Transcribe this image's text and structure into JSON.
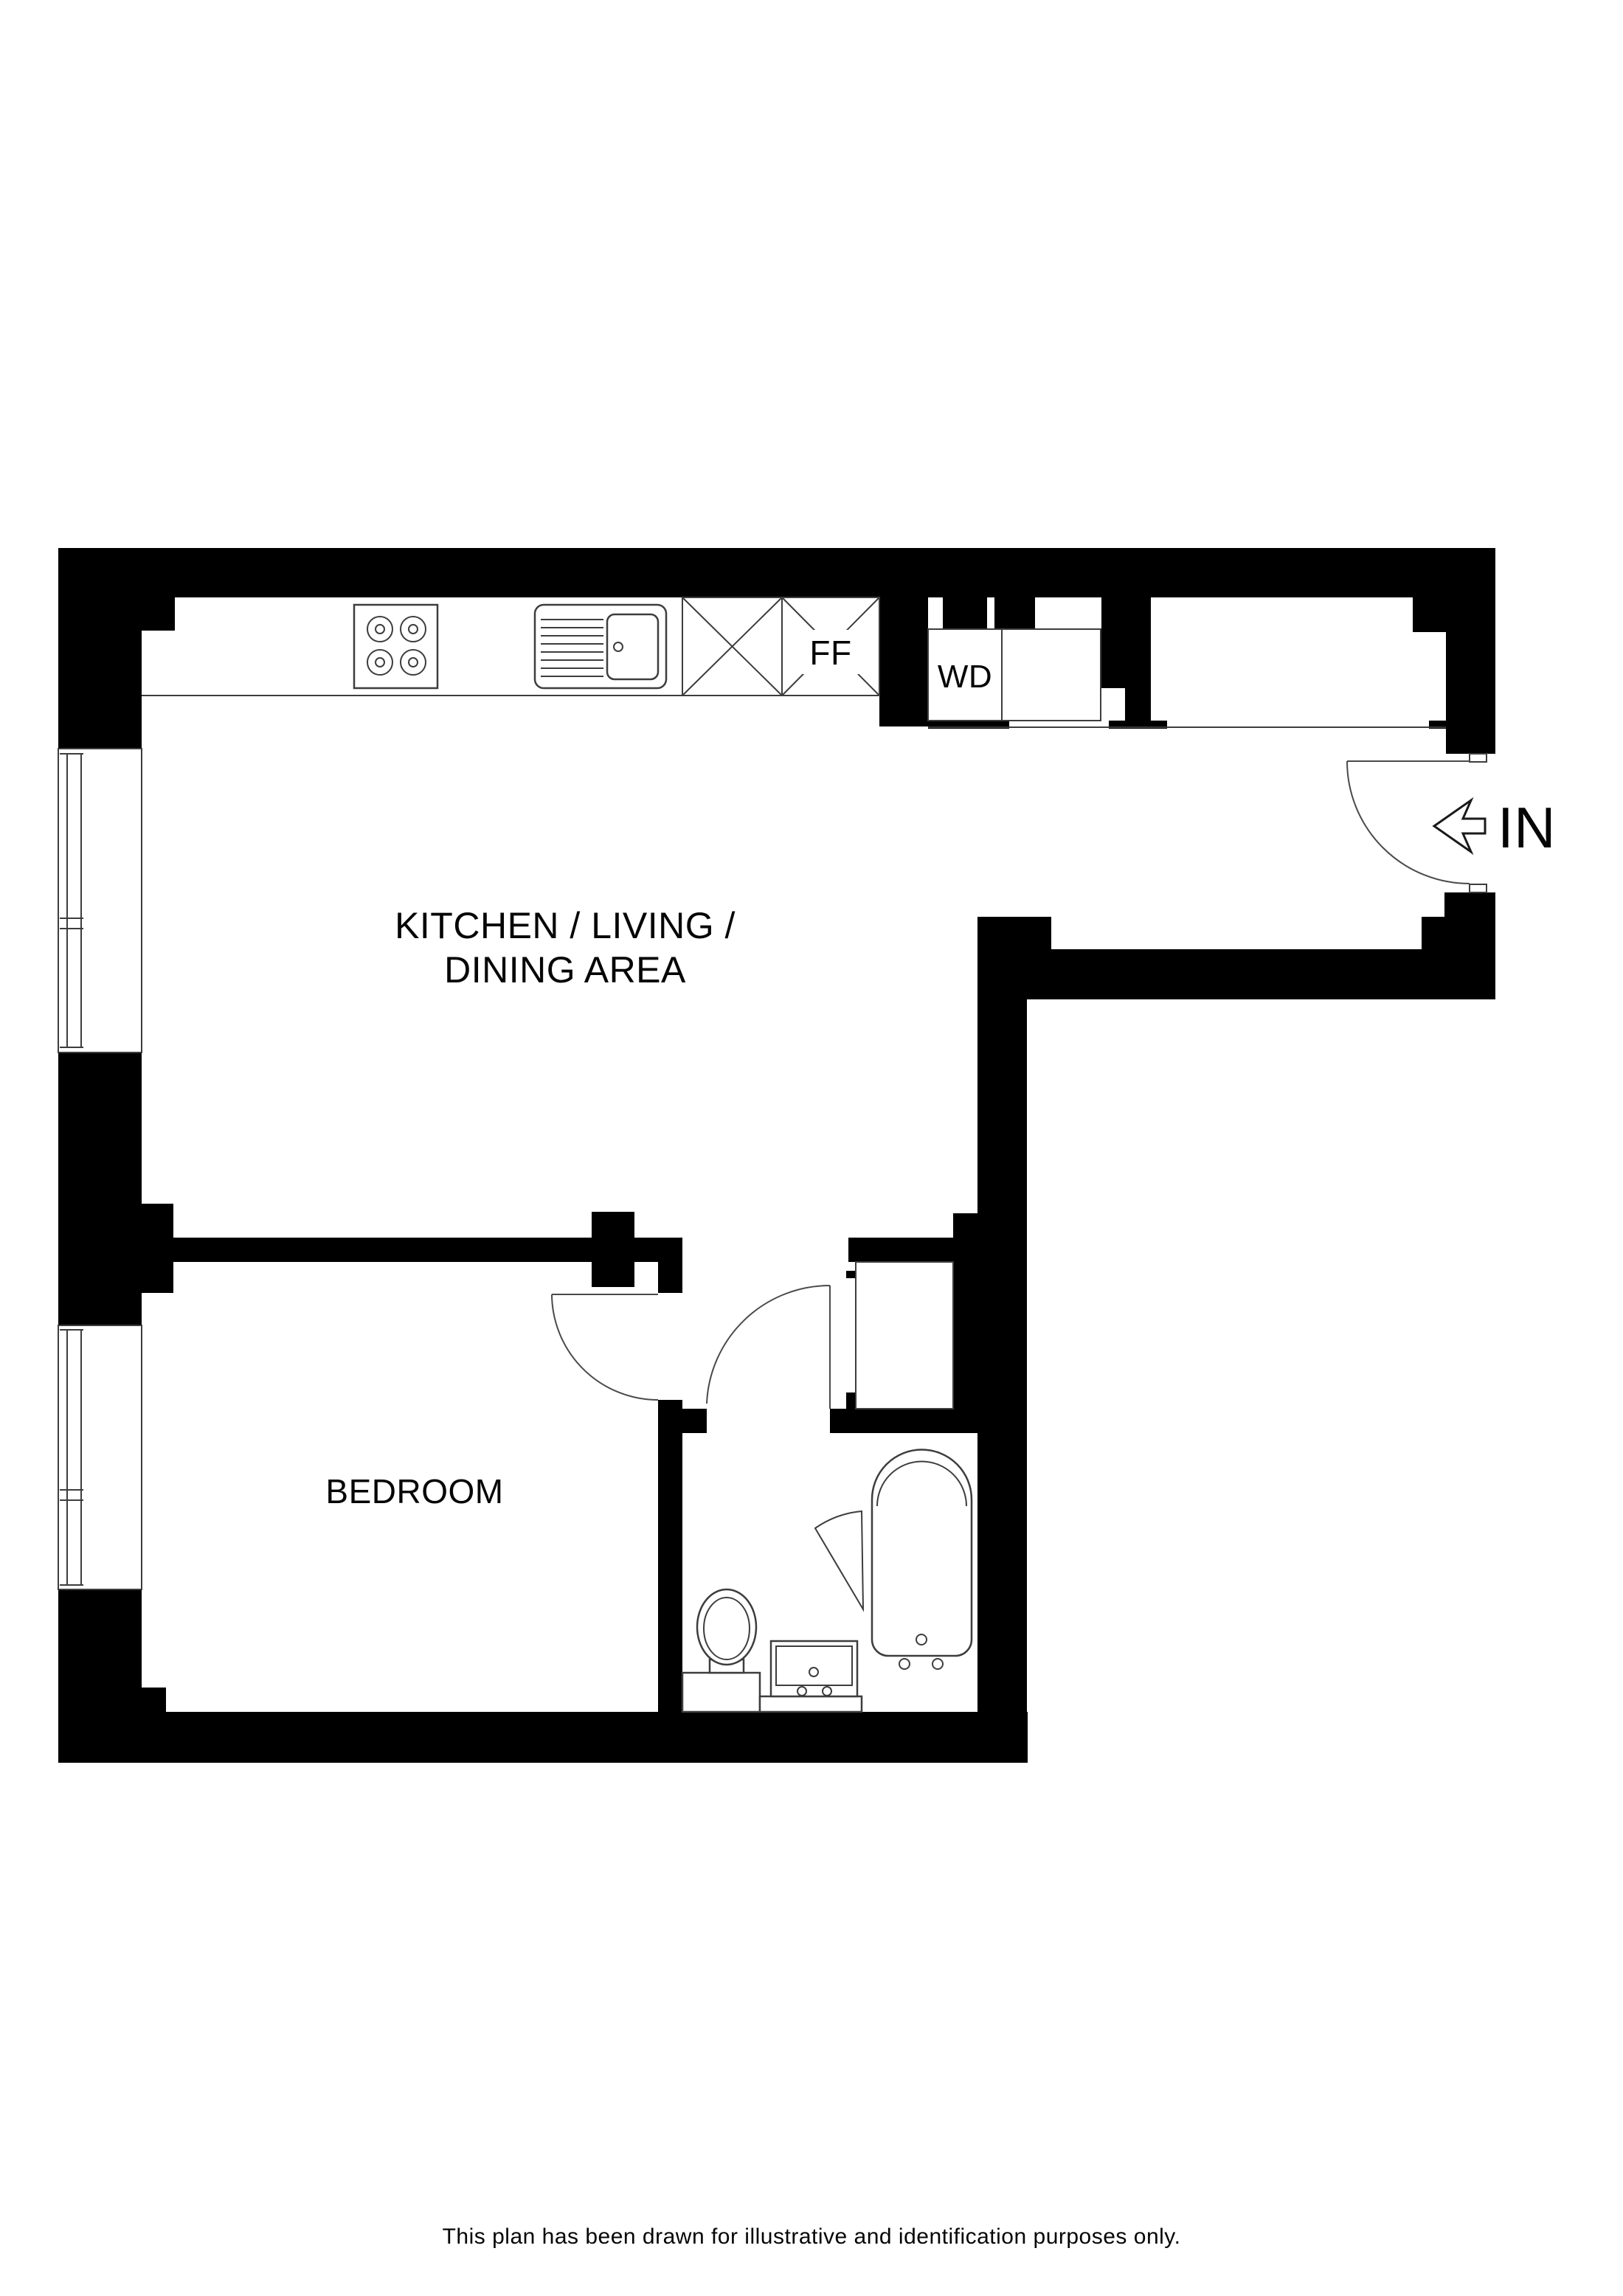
{
  "floorplan": {
    "rooms": [
      {
        "id": "kitchen-living-dining",
        "label_line1": "KITCHEN / LIVING /",
        "label_line2": "DINING AREA"
      },
      {
        "id": "bedroom",
        "label": "BEDROOM"
      }
    ],
    "appliances": {
      "fridge_freezer_label": "FF",
      "washer_dryer_label": "WD"
    },
    "entrance": {
      "label": "IN"
    },
    "footer": {
      "disclaimer": "This plan has been drawn for illustrative and identification purposes only."
    }
  }
}
